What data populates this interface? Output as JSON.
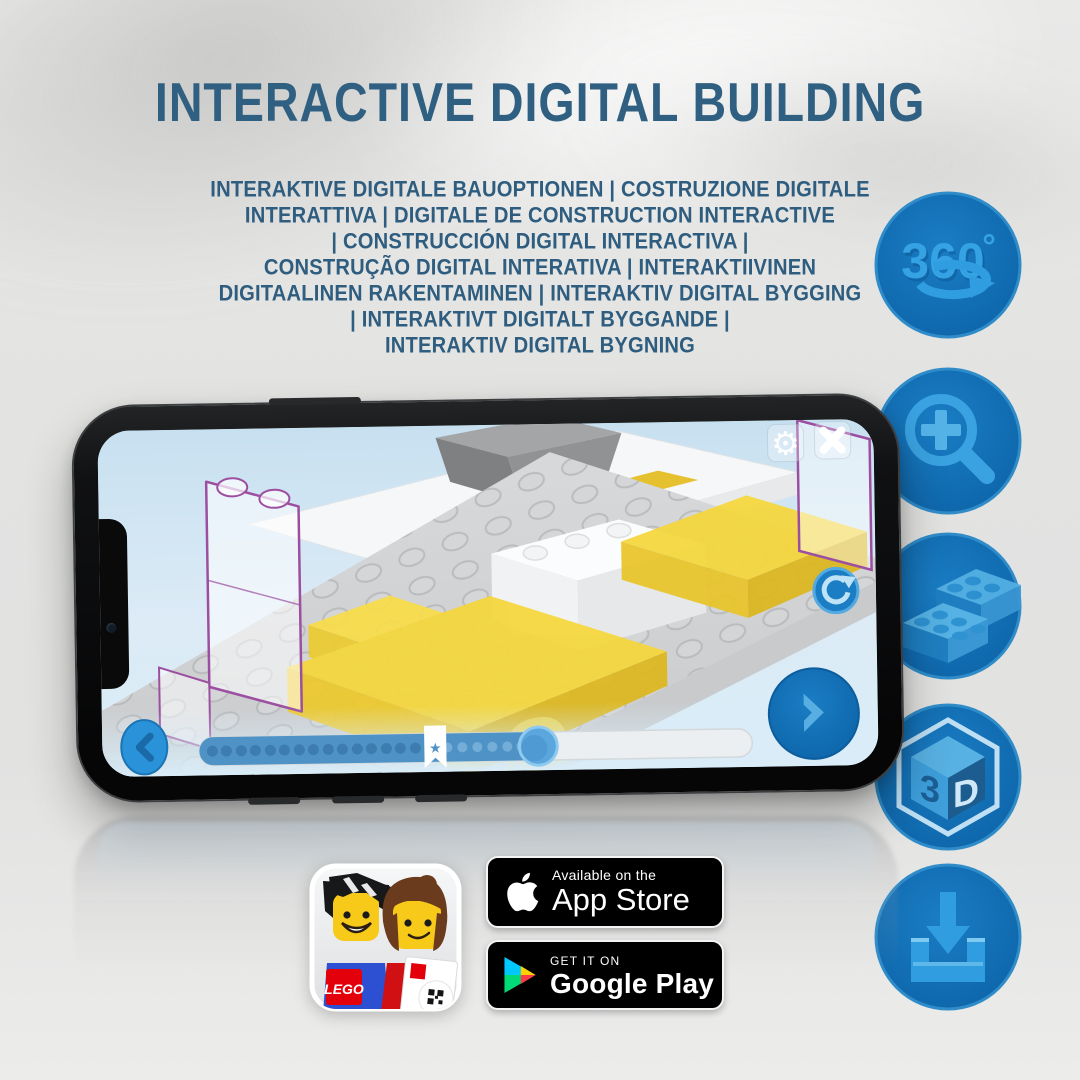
{
  "title": "INTERACTIVE DIGITAL BUILDING",
  "subtitle": {
    "lines": [
      "INTERAKTIVE DIGITALE BAUOPTIONEN | COSTRUZIONE DIGITALE",
      "INTERATTIVA | DIGITALE DE CONSTRUCTION INTERACTIVE",
      "| CONSTRUCCIÓN DIGITAL INTERACTIVA |",
      "CONSTRUÇÃO DIGITAL INTERATIVA | INTERAKTIIVINEN",
      "DIGITAALINEN RAKENTAMINEN | INTERAKTIV DIGITAL BYGGING",
      "| INTERAKTIVT DIGITALT BYGGANDE |",
      "INTERAKTIV DIGITAL BYGNING"
    ]
  },
  "feature_icons": {
    "rotate_label": "360",
    "rotate_degree": "°",
    "cube_3": "3",
    "cube_d": "D"
  },
  "phone_ui": {
    "gear_glyph": "⚙",
    "bookmark_star": "★",
    "progress_percent_filled": 62,
    "bookmark_position_percent": 43
  },
  "badges": {
    "app_store": {
      "tagline": "Available on the",
      "store": "App Store"
    },
    "google_play": {
      "tagline": "GET IT ON",
      "store": "Google Play"
    }
  },
  "app_icon": {
    "lego_logo": "LEGO"
  },
  "colors": {
    "title_blue": "#2f5f81",
    "icon_circle_blue": "#1173bb",
    "icon_glyph_blue": "#35a3e3",
    "brick_yellow": "#f5d73b",
    "ghost_outline_purple": "#9c4fa0"
  }
}
